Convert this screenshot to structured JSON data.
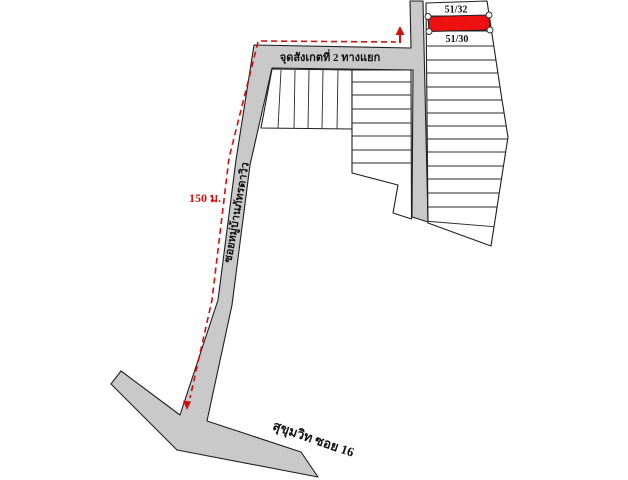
{
  "map": {
    "plots": {
      "top_plot_label": "51/32",
      "bottom_plot_label": "51/30",
      "highlighted_plot": "red plot between 51/32 and 51/30"
    },
    "roads": {
      "junction_label": "จุดสังเกตที่ 2  ทางแยก",
      "soi_label": "ซอยหมู่บ้านภัทรดาวิว",
      "main_road_label": "สุขุมวิท ซอย 16"
    },
    "route": {
      "distance_label": "150 ม."
    },
    "colors": {
      "road_fill": "#c9c9c9",
      "plot_fill": "#ffffff",
      "highlight_fill": "#ee1111",
      "route_color": "#cc1111",
      "outline_color": "#1f1f1f",
      "handle_fill": "#ffffff"
    }
  }
}
